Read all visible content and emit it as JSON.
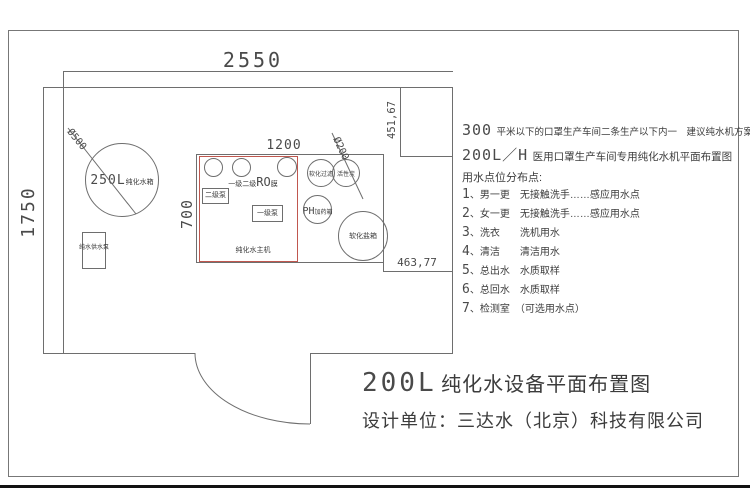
{
  "colors": {
    "line": "#6e6e6e",
    "red_box": "#c0574f",
    "text": "#3c3c3c",
    "edge": "#111111"
  },
  "drawing": {
    "dims": {
      "room_width": "2550",
      "room_height": "1750",
      "equip_width": "1200",
      "equip_height": "700",
      "closet_depth": "451,67",
      "step_width": "463,77",
      "tank_diameter": "Ø500",
      "carbon_diameter": "Ø200"
    },
    "tank": {
      "size_big": "250L",
      "label": "纯化水箱"
    },
    "supply_pump_label": "纯水供水泵",
    "equipment": {
      "ro_prefix": "一级二级",
      "ro_big": "RO",
      "ro_suffix": "膜",
      "pump2": "二级泵",
      "pump1": "一级泵",
      "host": "纯化水主机",
      "softener": "软化过滤",
      "carbon": "活性炭",
      "ph_big": "PH",
      "ph_small": "加药箱",
      "salt_tank": "软化盐箱"
    }
  },
  "notes": {
    "line1_big": "300",
    "line1_text": "平米以下的口罩生产车间二条生产以下内一　建议纯水机方案",
    "line2_big": "200L／H",
    "line2_text": "医用口罩生产车间专用纯化水机平面布置图",
    "heading": "用水点位分布点:",
    "items": [
      {
        "num": "1",
        "text": "、男一更　无接触洗手……感应用水点"
      },
      {
        "num": "2",
        "text": "、女一更　无接触洗手……感应用水点"
      },
      {
        "num": "3",
        "text": "、洗衣　　洗机用水"
      },
      {
        "num": "4",
        "text": "、清洁　　清洁用水"
      },
      {
        "num": "5",
        "text": "、总出水　水质取样"
      },
      {
        "num": "6",
        "text": "、总回水　水质取样"
      },
      {
        "num": "7",
        "text": "、检测室　（可选用水点）"
      }
    ]
  },
  "title": {
    "big": "200L",
    "rest": "纯化水设备平面布置图",
    "designer": "设计单位：三达水（北京）科技有限公司"
  }
}
